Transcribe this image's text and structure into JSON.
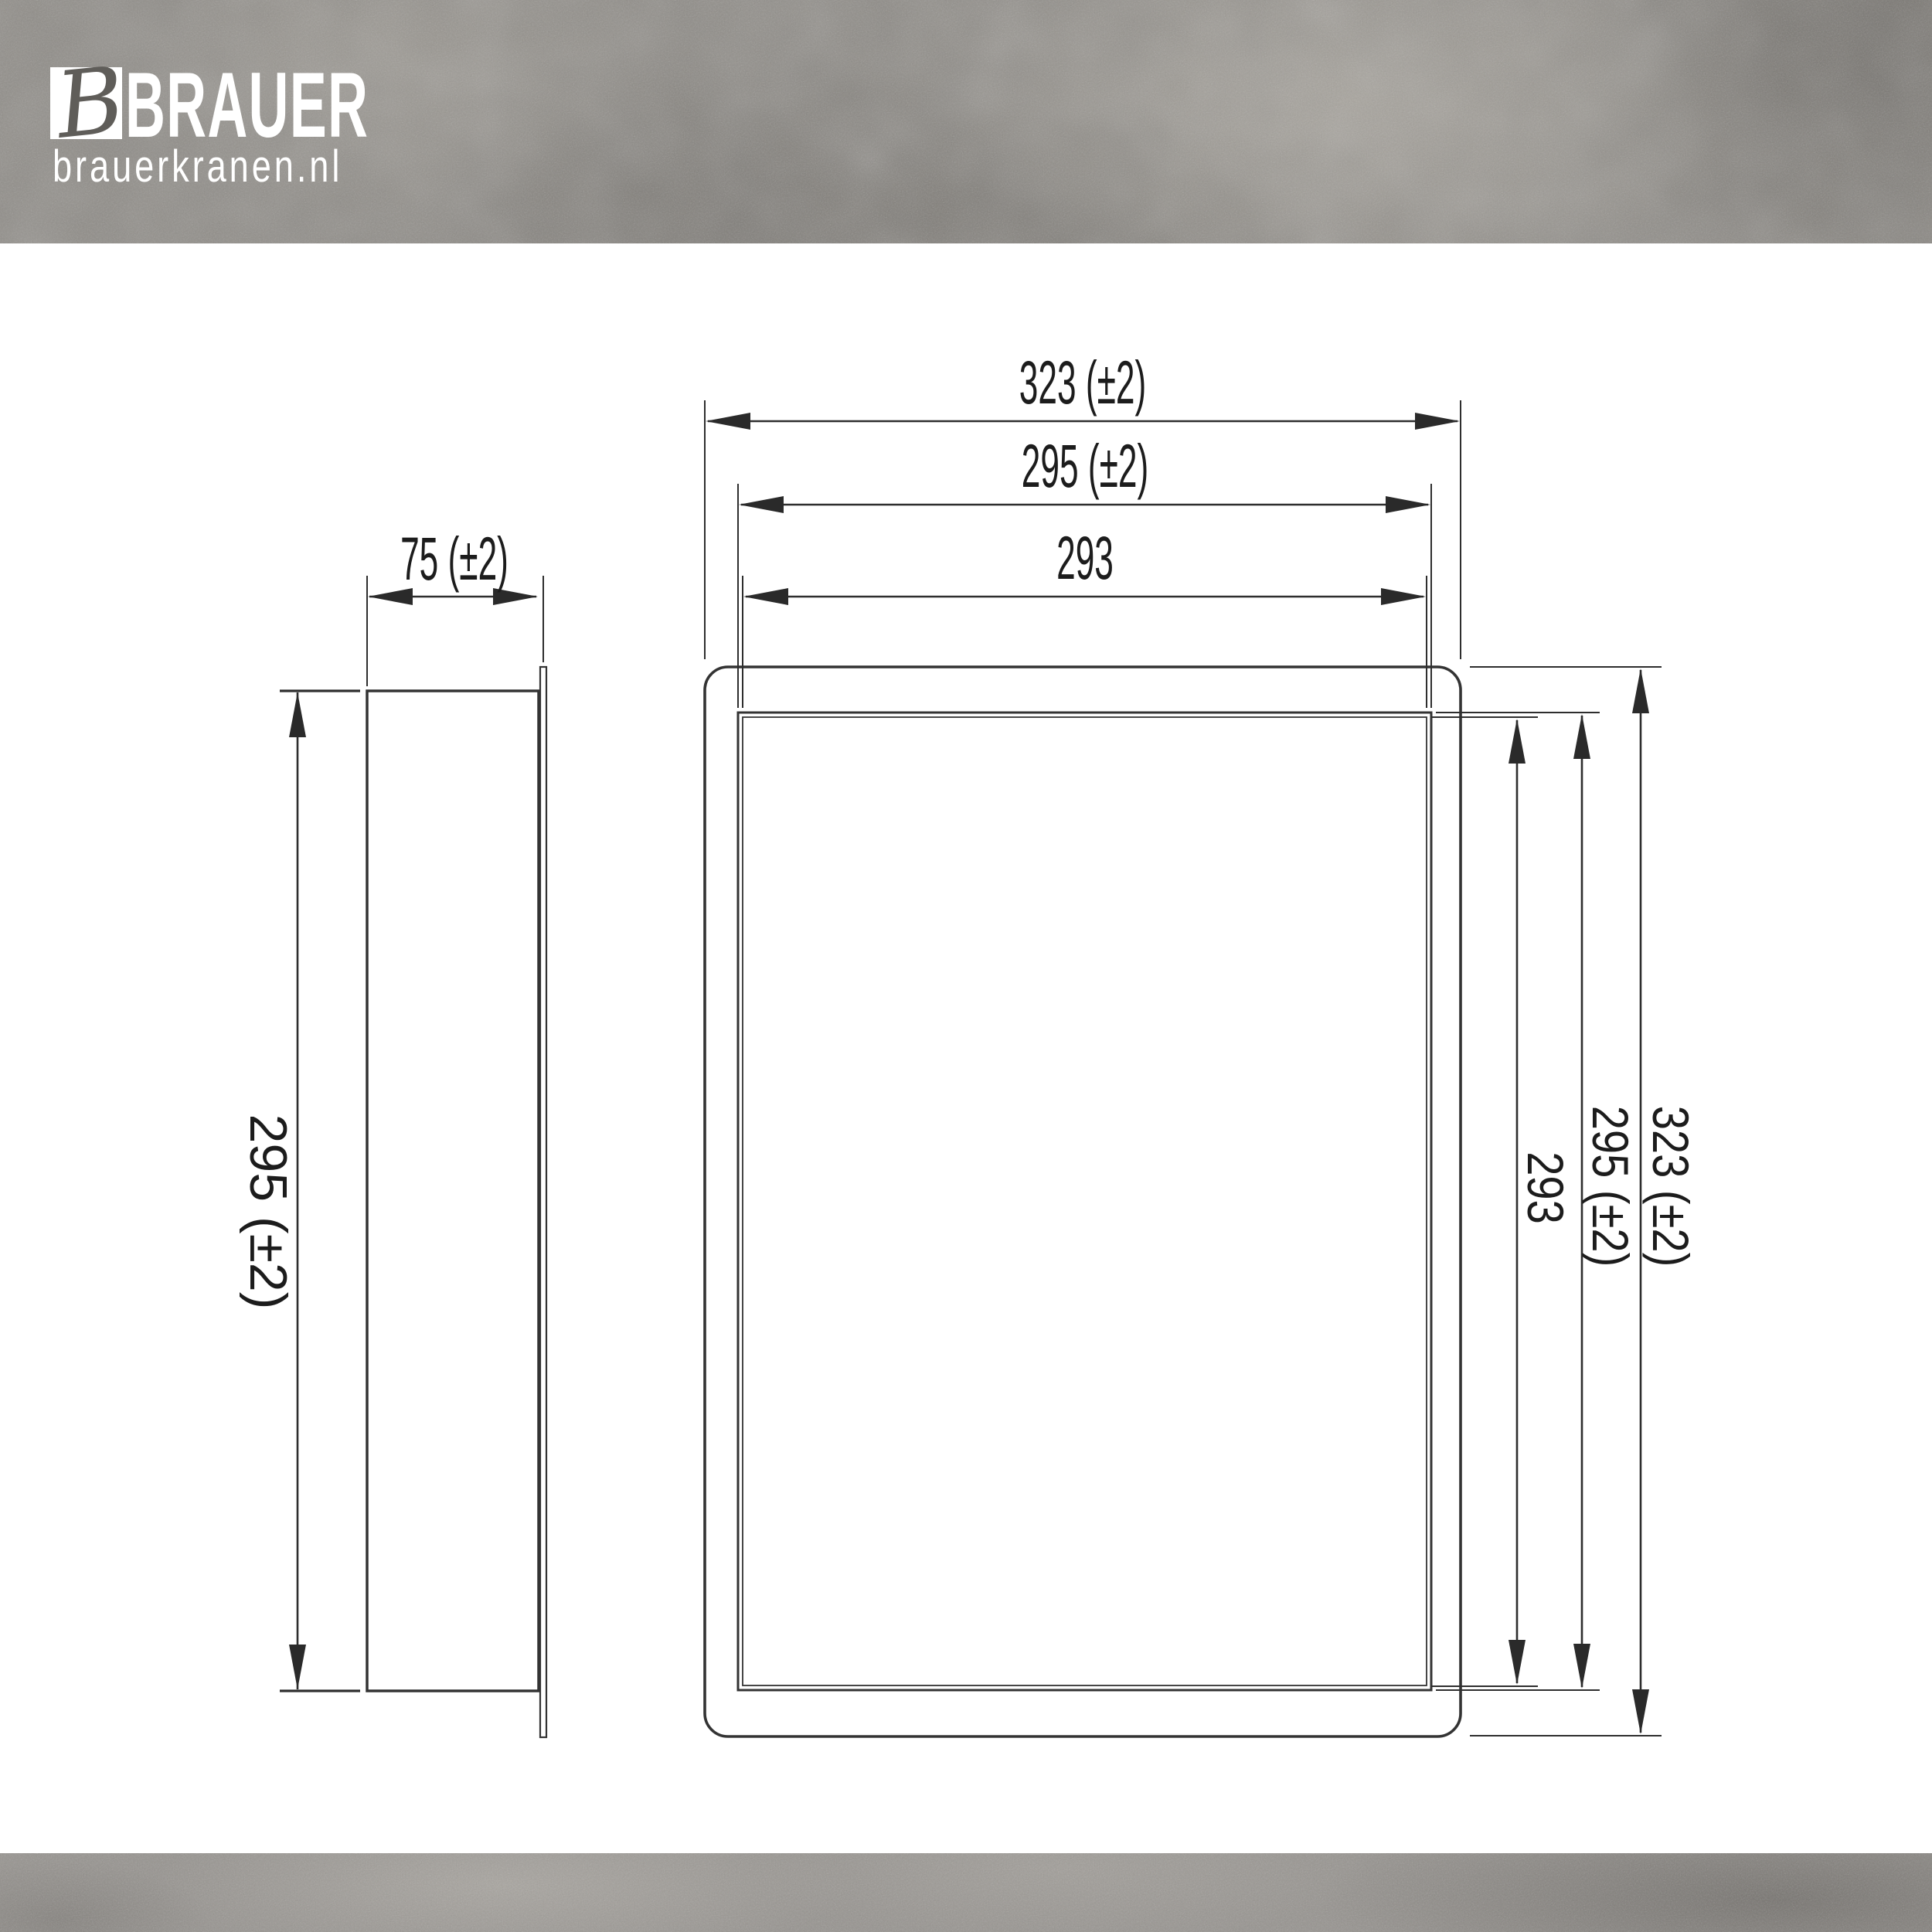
{
  "brand": {
    "monogram": "B",
    "name": "BRAUER",
    "website": "brauerkranen.nl"
  },
  "drawing": {
    "type": "technical-dimension-drawing",
    "views": {
      "left": "side view (niche depth)",
      "right": "front view (niche face)"
    },
    "front_view": {
      "width_total": "323 (±2)",
      "width_flange_inner": "295 (±2)",
      "width_opening": "293",
      "height_total": "323 (±2)",
      "height_flange_inner": "295 (±2)",
      "height_opening": "293"
    },
    "side_view": {
      "depth": "75 (±2)",
      "height": "295 (±2)"
    },
    "units": "mm",
    "colors": {
      "line": "#333333",
      "dimension_text": "#1c1c1c",
      "paper": "#ffffff",
      "concrete_base": "#8f8c87",
      "concrete_light": "#a8a49d",
      "concrete_dark": "#716e6a",
      "logo_text": "#ffffff",
      "monogram_ink": "#5f5d59"
    }
  }
}
